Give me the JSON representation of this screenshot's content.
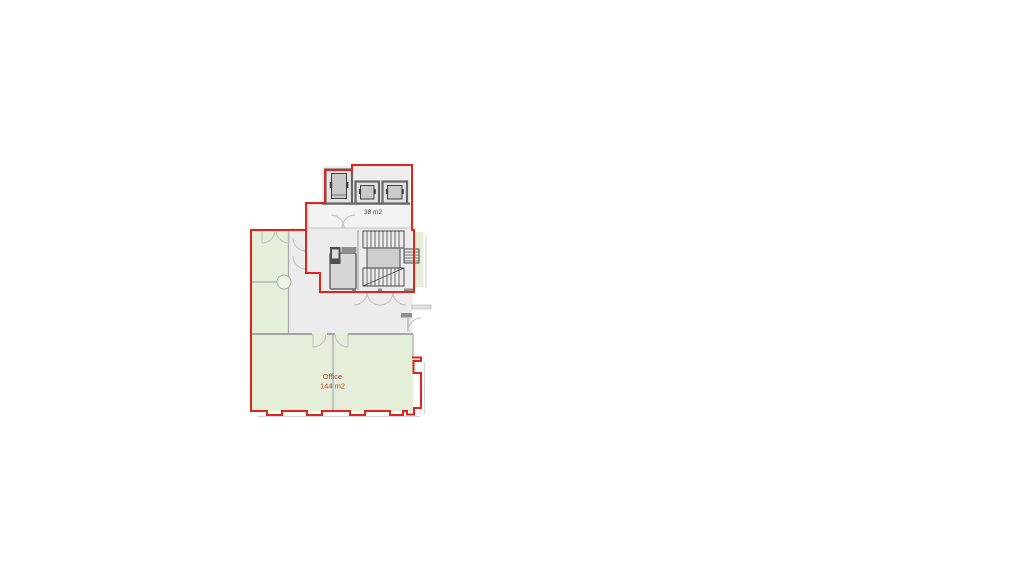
{
  "floorplan": {
    "labels": {
      "lobby_area": "38 m2",
      "office_name": "Office",
      "office_area": "144 m2"
    },
    "colors": {
      "outline_red": "#e0251b",
      "room_green": "#e5eed9",
      "core_gray": "#ececec",
      "room_gray_light": "#f3f3f3",
      "wall_gray": "#a8a8a8",
      "label_red": "#cf3b2d",
      "label_dark": "#3a3a3a"
    }
  }
}
